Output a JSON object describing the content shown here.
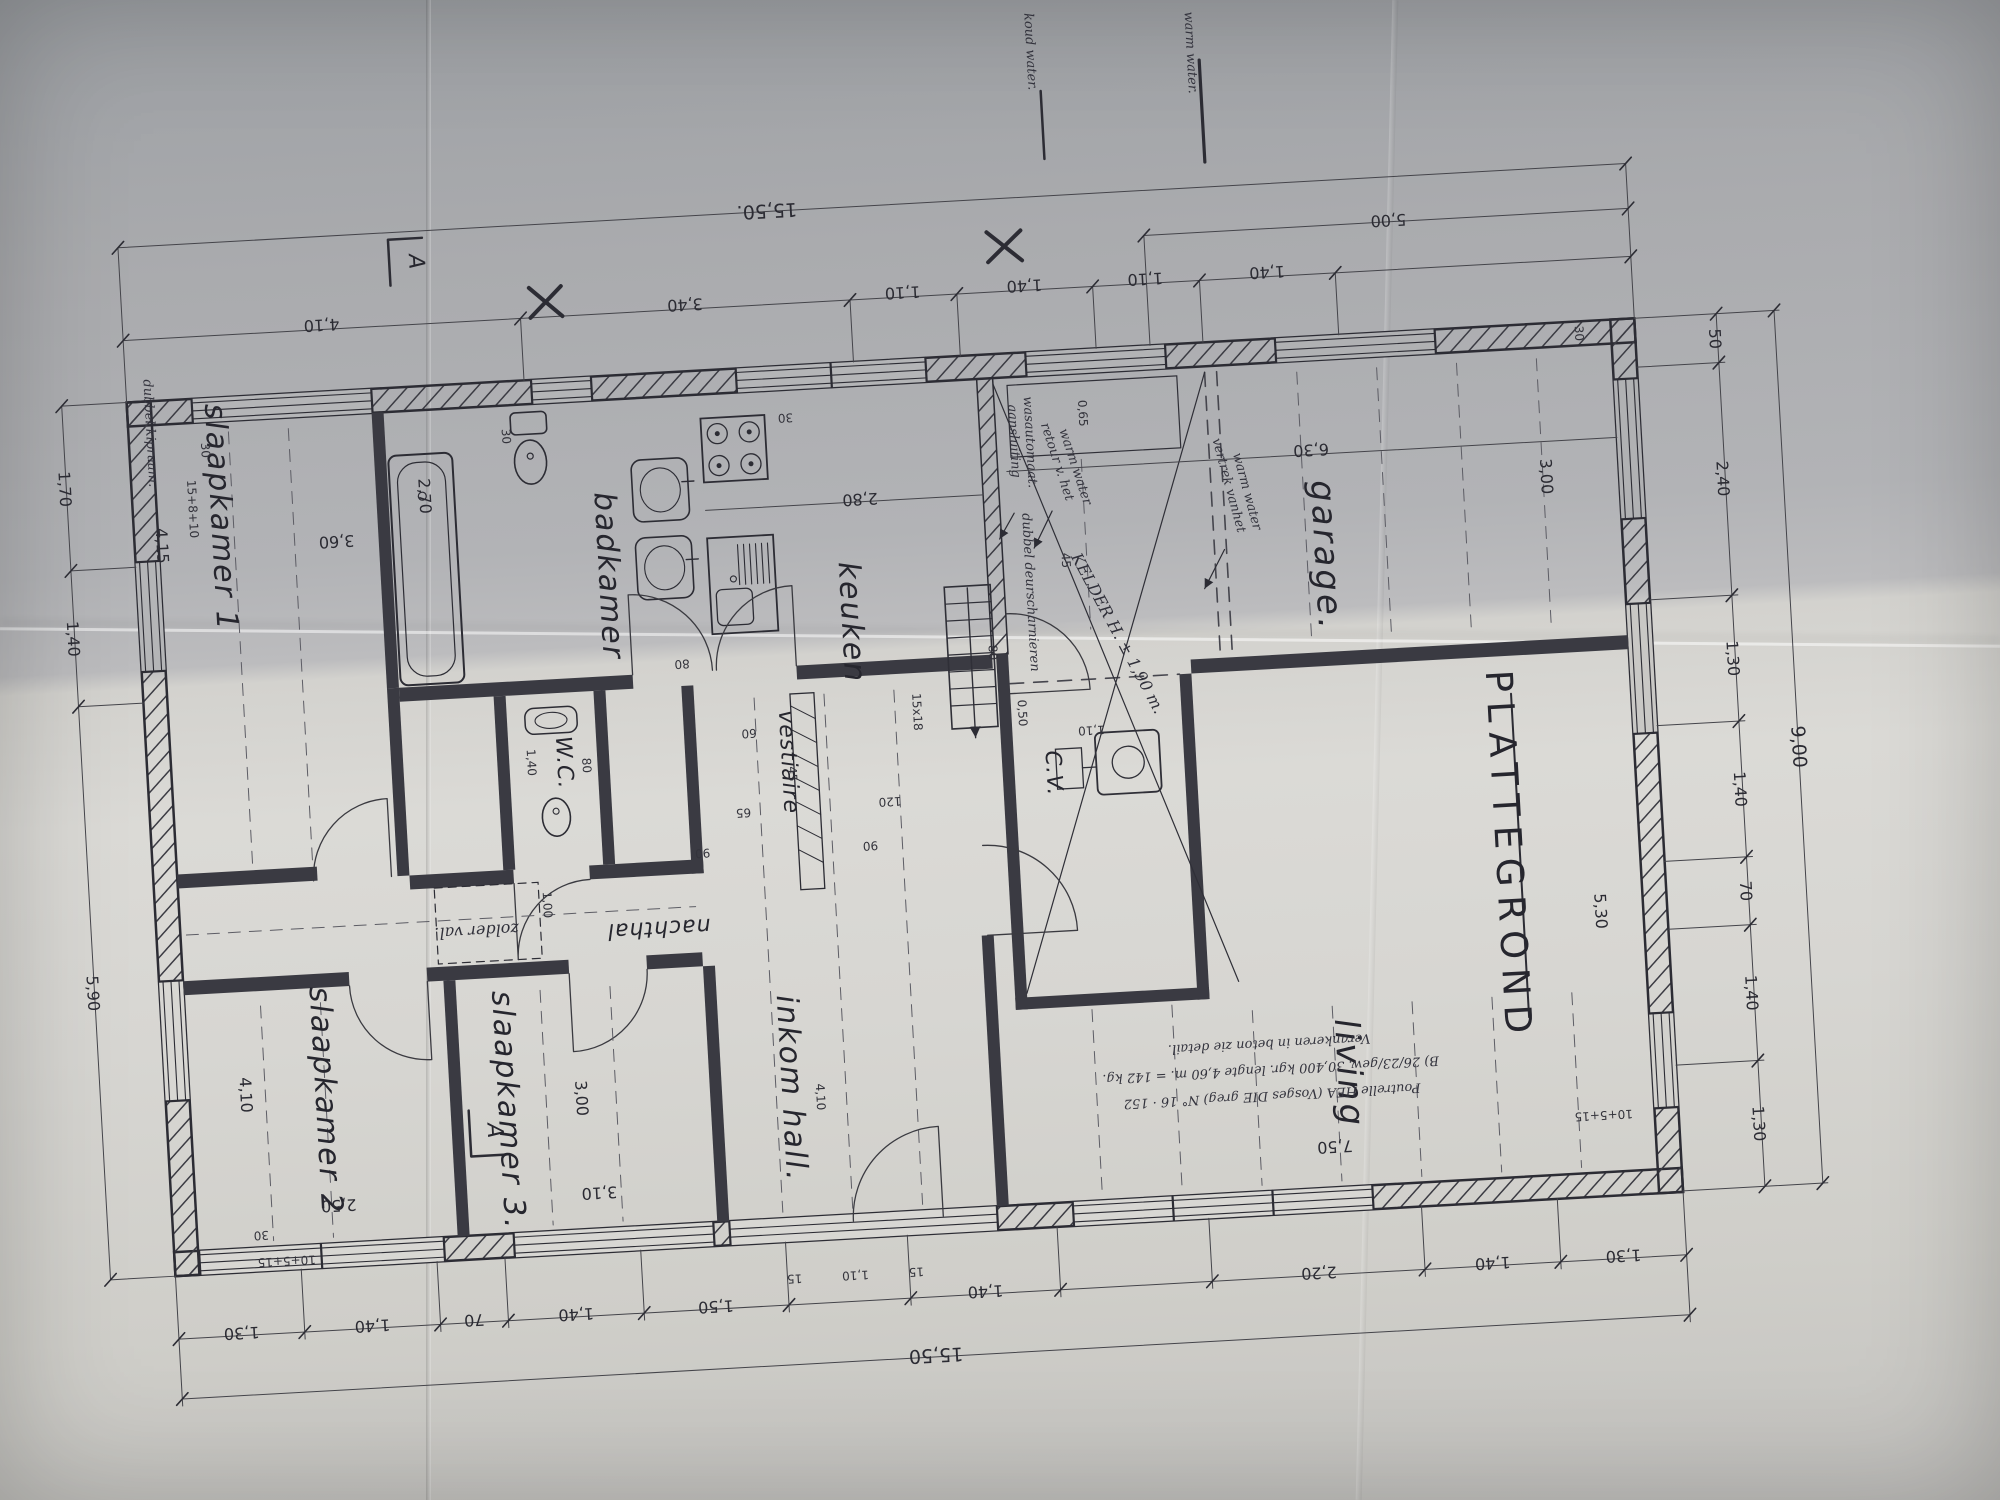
{
  "title": "PLATTEGROND",
  "section_mark": "A",
  "legend": {
    "cold": "koud water.",
    "warm": "warm water."
  },
  "rooms": {
    "slk1": "slaapkamer 1",
    "slk2": "slaapkamer 2",
    "slk3": "slaapkamer 3.",
    "badkamer": "badkamer",
    "keuken": "keuken",
    "garage": "garage.",
    "living": "living",
    "inkom": "inkom hall.",
    "nachthal": "nachthal",
    "vestiaire": "vestiaire",
    "wc": "W.C.",
    "cv": "C.V.",
    "zolder": "zolder val."
  },
  "dims": {
    "top_total": "15,50.",
    "top_5": "5,00",
    "top": [
      "4,10",
      "3,40",
      "1,10",
      "1,40",
      "1,10",
      "1,40"
    ],
    "bottom_total": "15,50",
    "bottom": [
      "1,30",
      "1,40",
      "70",
      "1,40",
      "1,50",
      "1,40",
      "2,20",
      "1,40",
      "1,30"
    ],
    "bottom_small": [
      "15",
      "1,10",
      "15"
    ],
    "left": [
      "1,70",
      "1,40",
      "5,90"
    ],
    "right": [
      "50",
      "2,40",
      "1,30",
      "1,40",
      "70",
      "1,40",
      "1,30"
    ],
    "right_total": "9,00",
    "right_inner": [
      "30",
      "3,00",
      "5,30"
    ],
    "slk1_w": "3,60",
    "slk1_h": "4,15",
    "slk2_w": "2,50",
    "slk2_h": "4,10",
    "slk3_w": "3,10",
    "slk3_h": "3,00",
    "keuken_w": "2,80",
    "garage_w": "6,30",
    "living_w": "7,50",
    "inkom_w": "4,10",
    "tub": "2,70",
    "wc_w": "80",
    "wc_h": "1,40",
    "misc": {
      "d60": "60",
      "d65": "65",
      "d90a": "90",
      "d90b": "90",
      "d120": "120",
      "d45a": "45",
      "d45b": "45",
      "d100": "1,00",
      "d80a": "80",
      "d80b": "80",
      "d050": "0,50",
      "d110": "1,10",
      "d065": "0,65",
      "d15x18": "15x18",
      "d30a": "30",
      "d30b": "30",
      "d30c": "30",
      "d30d": "30"
    },
    "wall": {
      "a": "15+8+10",
      "b": "10+5+15",
      "c": "10+5+15"
    }
  },
  "notes": {
    "window": "dubbel kipraam.",
    "wash1": "aansluiting",
    "wash2": "wasautomaat.",
    "hinge": "dubbel deurscharnieren",
    "hot_return1": "retour v. het",
    "hot_return2": "warm water",
    "hot_supply1": "vertrek vanhet",
    "hot_supply2": "warm water",
    "kelder": "KELDER H. ± 1,90 m.",
    "beam1": "Poutrelle HEA (Vosges DIE greg) N° 16 · 152",
    "beam2": "B) 26/23/gew. 30,400 kgr. lengte 4,60 m. = 142 kg.",
    "beam3": "Verankeren in beton zie detail."
  }
}
